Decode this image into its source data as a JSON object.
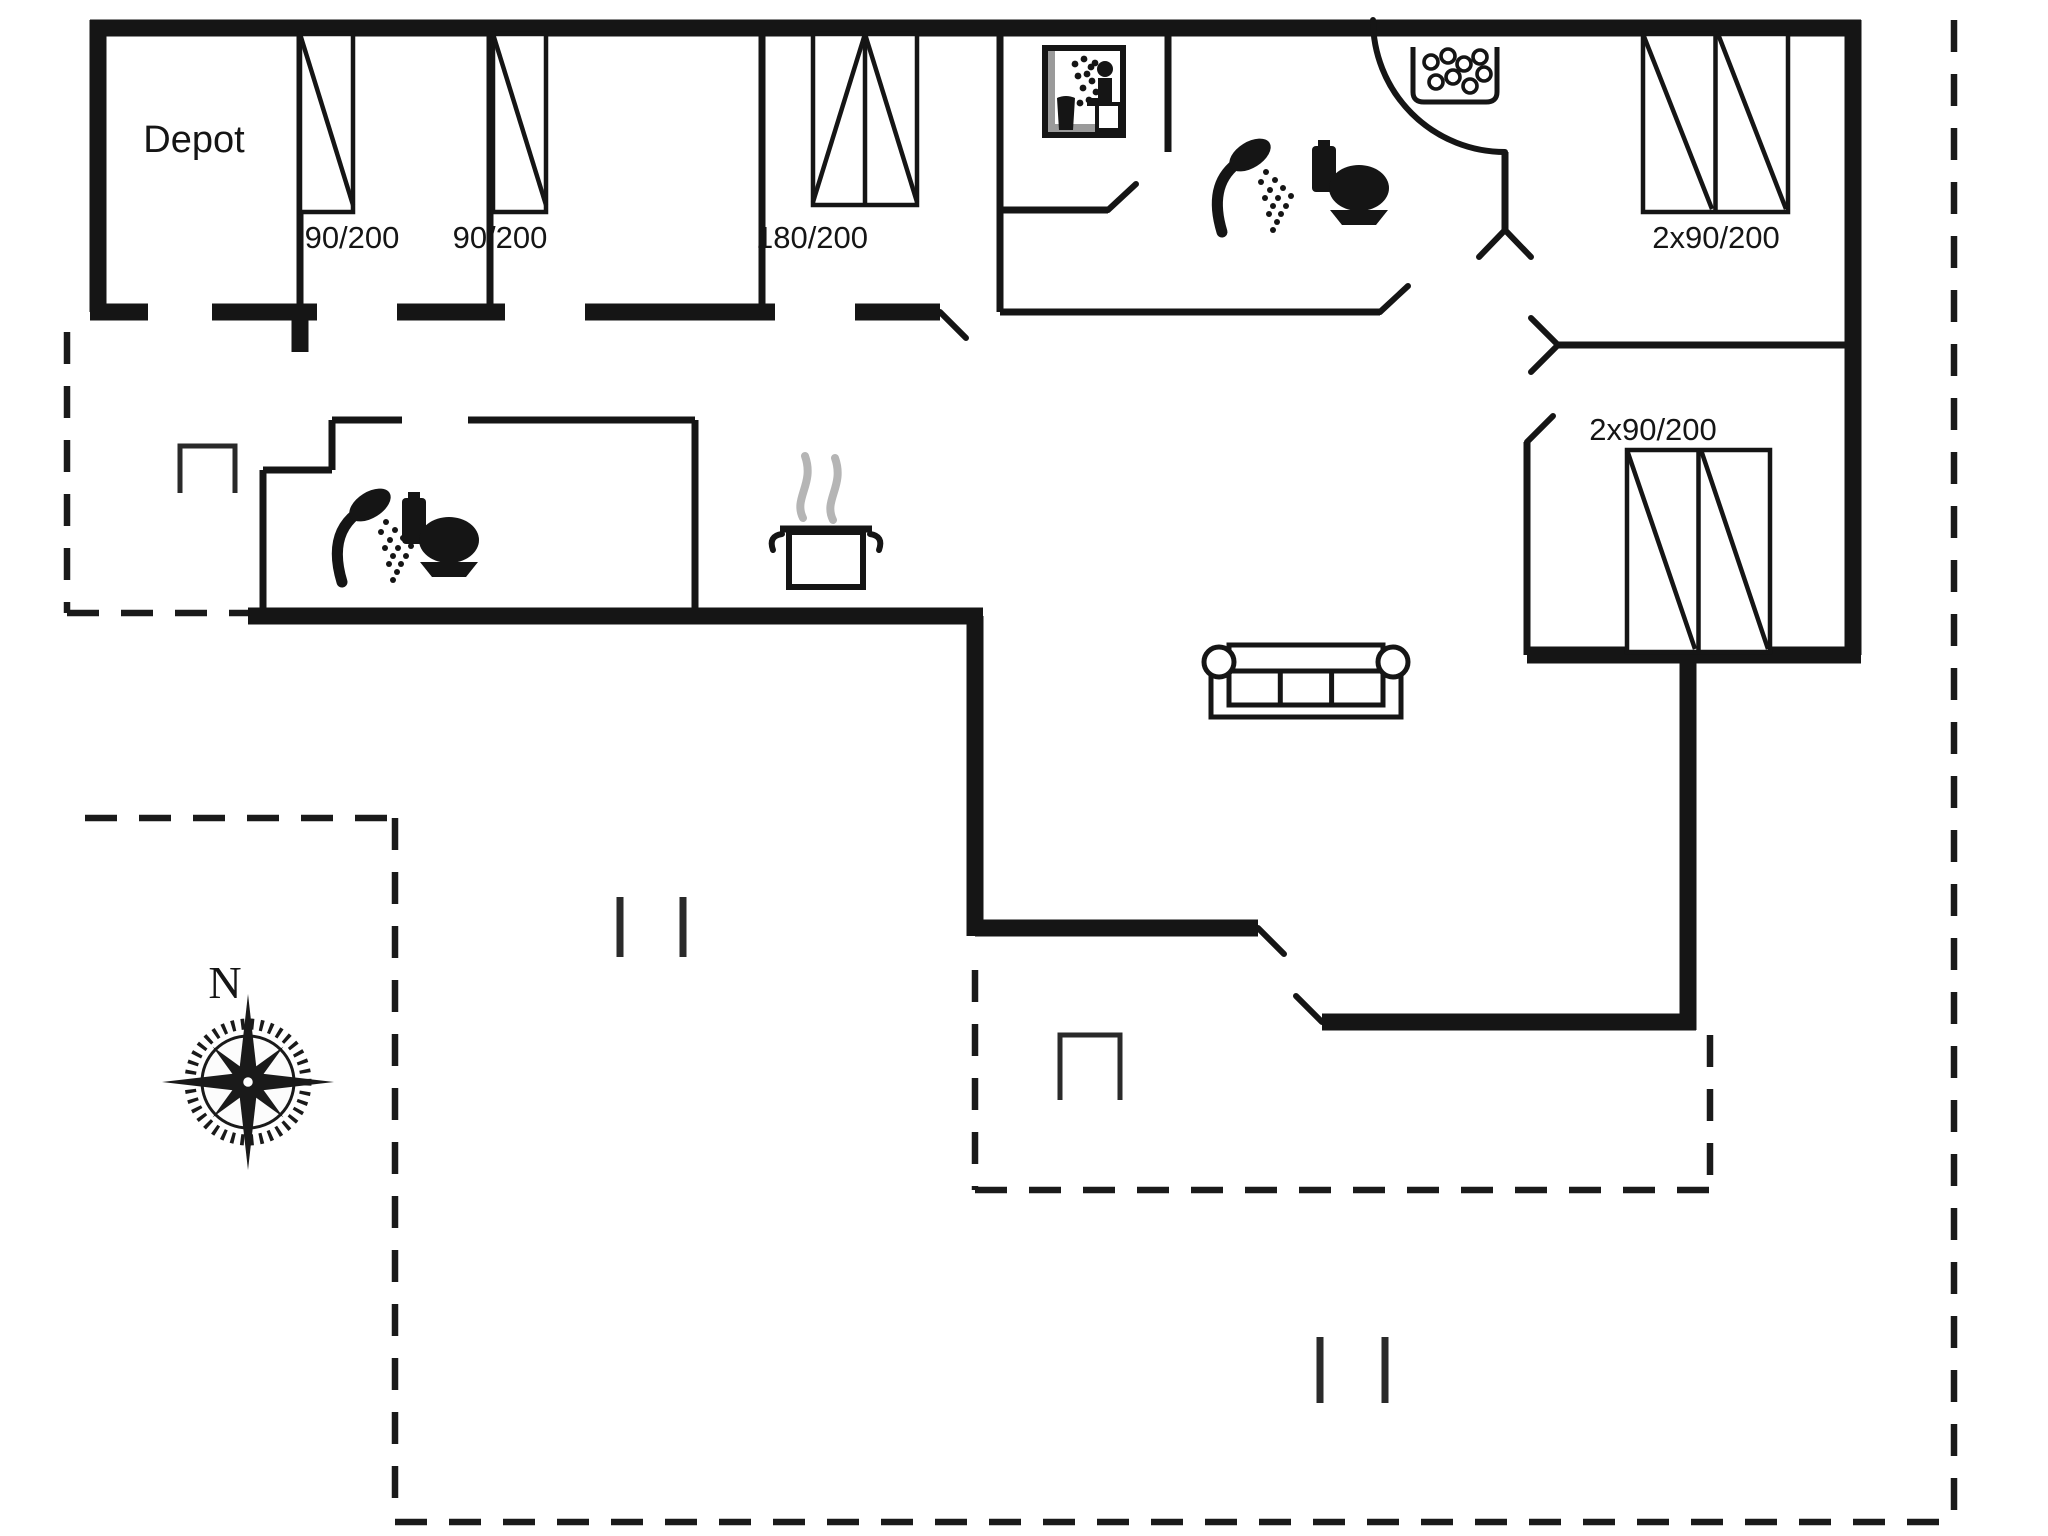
{
  "document": {
    "type": "floor-plan",
    "background": "#ffffff",
    "ink_color": "#151515",
    "steam_color": "#b5b5b5"
  },
  "rooms": {
    "depot": {
      "label": "Depot"
    },
    "bedroom_1": {
      "bed_size": "90/200"
    },
    "bedroom_2": {
      "bed_size": "90/200"
    },
    "bedroom_3": {
      "bed_size": "180/200"
    },
    "bedroom_4": {
      "bed_size": "2x90/200"
    },
    "bedroom_5": {
      "bed_size": "2x90/200"
    }
  },
  "compass": {
    "label": "N"
  },
  "icons": [
    "sauna-icon",
    "shower-icon-bathroom-1",
    "toilet-icon-bathroom-1",
    "whirlpool-icon",
    "shower-icon-bathroom-2",
    "toilet-icon-bathroom-2",
    "cooking-pot-icon",
    "sofa-icon",
    "compass-rose-icon"
  ]
}
